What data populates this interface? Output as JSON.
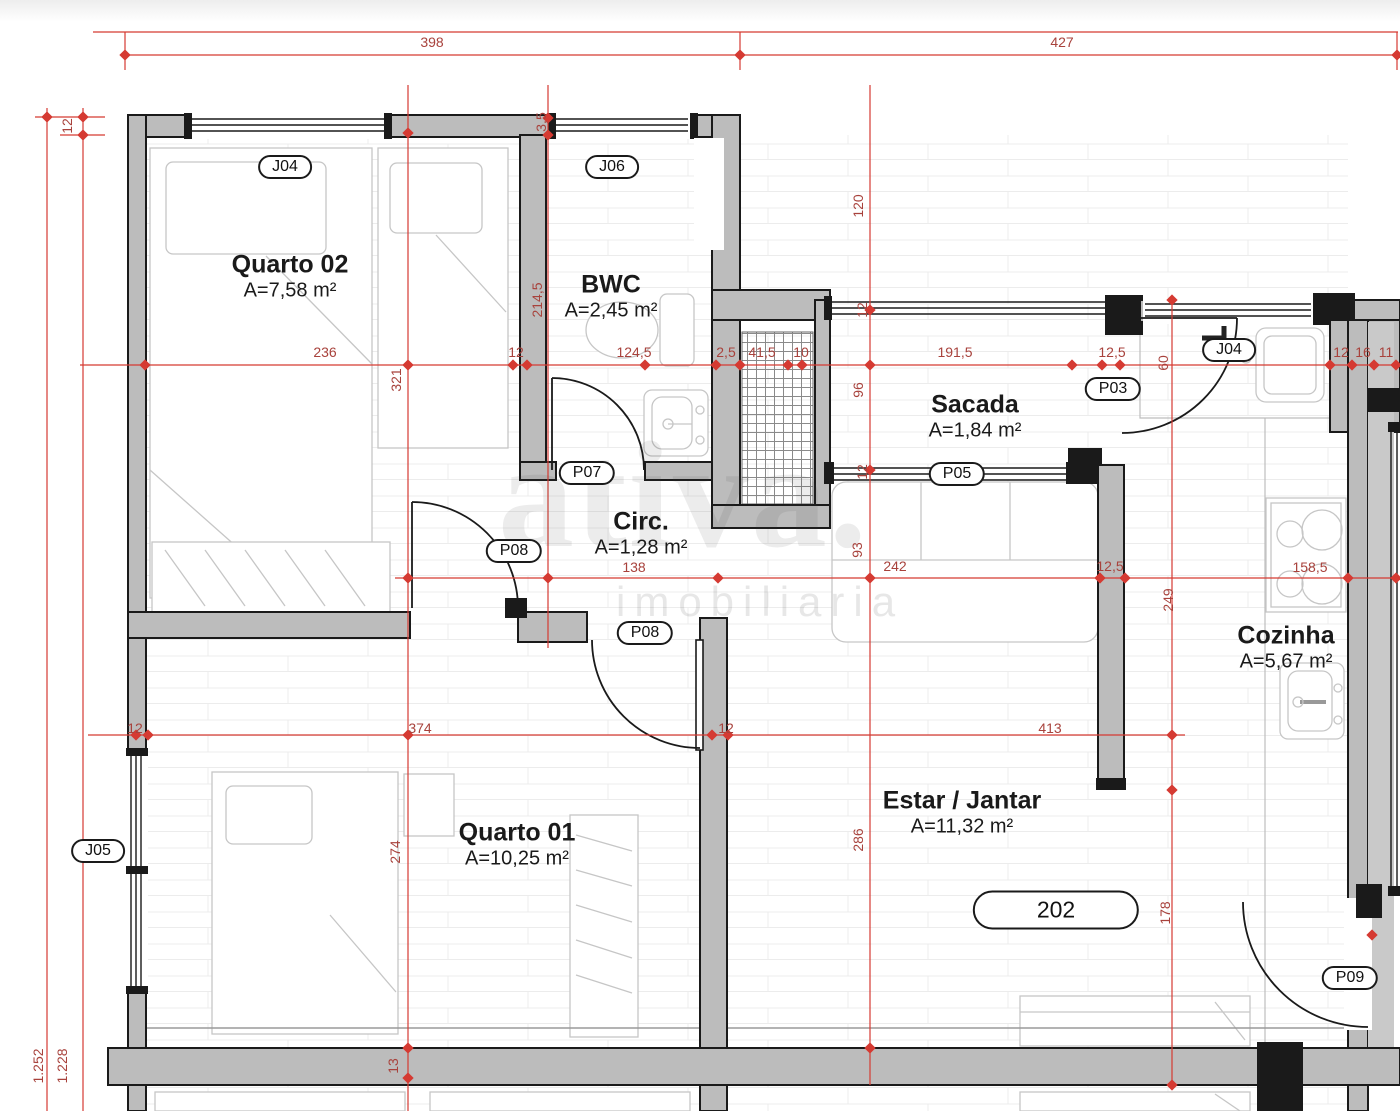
{
  "watermark": {
    "brand": "ativa.",
    "subtitle": "imobiliaria"
  },
  "unit_tag": {
    "label": "202",
    "x": 1056,
    "y": 910
  },
  "rooms": [
    {
      "id": "quarto-02",
      "name": "Quarto 02",
      "area": "A=7,58 m²",
      "x": 290,
      "y": 277
    },
    {
      "id": "bwc",
      "name": "BWC",
      "area": "A=2,45 m²",
      "x": 611,
      "y": 297
    },
    {
      "id": "sacada",
      "name": "Sacada",
      "area": "A=1,84 m²",
      "x": 975,
      "y": 417
    },
    {
      "id": "circ",
      "name": "Circ.",
      "area": "A=1,28 m²",
      "x": 641,
      "y": 534
    },
    {
      "id": "cozinha",
      "name": "Cozinha",
      "area": "A=5,67 m²",
      "x": 1286,
      "y": 648
    },
    {
      "id": "quarto-01",
      "name": "Quarto 01",
      "area": "A=10,25 m²",
      "x": 517,
      "y": 845
    },
    {
      "id": "estar-jantar",
      "name": "Estar / Jantar",
      "area": "A=11,32 m²",
      "x": 962,
      "y": 813
    }
  ],
  "door_window_tags": [
    {
      "label": "J04",
      "x": 285,
      "y": 167
    },
    {
      "label": "J06",
      "x": 612,
      "y": 167
    },
    {
      "label": "P07",
      "x": 587,
      "y": 473
    },
    {
      "label": "P08",
      "x": 514,
      "y": 551
    },
    {
      "label": "P08",
      "x": 645,
      "y": 633
    },
    {
      "label": "P05",
      "x": 957,
      "y": 474
    },
    {
      "label": "P03",
      "x": 1113,
      "y": 389
    },
    {
      "label": "J04",
      "x": 1229,
      "y": 350
    },
    {
      "label": "J05",
      "x": 98,
      "y": 851
    },
    {
      "label": "P09",
      "x": 1350,
      "y": 978
    }
  ],
  "dimensions_horizontal": [
    {
      "t": "398",
      "x": 432,
      "y": 42
    },
    {
      "t": "427",
      "x": 1062,
      "y": 42
    },
    {
      "t": "236",
      "x": 325,
      "y": 352
    },
    {
      "t": "12",
      "x": 516,
      "y": 352
    },
    {
      "t": "124,5",
      "x": 634,
      "y": 352
    },
    {
      "t": "2,5",
      "x": 726,
      "y": 352
    },
    {
      "t": "41,5",
      "x": 762,
      "y": 352
    },
    {
      "t": "10",
      "x": 801,
      "y": 352
    },
    {
      "t": "191,5",
      "x": 955,
      "y": 352
    },
    {
      "t": "12,5",
      "x": 1112,
      "y": 352
    },
    {
      "t": "12",
      "x": 1341,
      "y": 352
    },
    {
      "t": "16",
      "x": 1363,
      "y": 352
    },
    {
      "t": "11",
      "x": 1386,
      "y": 352
    },
    {
      "t": "138",
      "x": 634,
      "y": 567
    },
    {
      "t": "242",
      "x": 895,
      "y": 566
    },
    {
      "t": "12,5",
      "x": 1110,
      "y": 566
    },
    {
      "t": "158,5",
      "x": 1310,
      "y": 567
    },
    {
      "t": "374",
      "x": 420,
      "y": 728
    },
    {
      "t": "12",
      "x": 726,
      "y": 728
    },
    {
      "t": "413",
      "x": 1050,
      "y": 728
    },
    {
      "t": "12",
      "x": 135,
      "y": 728
    }
  ],
  "dimensions_vertical": [
    {
      "t": "12",
      "x": 67,
      "y": 126
    },
    {
      "t": "3,5",
      "x": 541,
      "y": 122
    },
    {
      "t": "214,5",
      "x": 537,
      "y": 300
    },
    {
      "t": "120",
      "x": 858,
      "y": 206
    },
    {
      "t": "12",
      "x": 862,
      "y": 310
    },
    {
      "t": "96",
      "x": 858,
      "y": 390
    },
    {
      "t": "12",
      "x": 862,
      "y": 472
    },
    {
      "t": "321",
      "x": 396,
      "y": 380
    },
    {
      "t": "93",
      "x": 857,
      "y": 550
    },
    {
      "t": "60",
      "x": 1163,
      "y": 363
    },
    {
      "t": "249",
      "x": 1168,
      "y": 600
    },
    {
      "t": "274",
      "x": 395,
      "y": 852
    },
    {
      "t": "286",
      "x": 858,
      "y": 840
    },
    {
      "t": "178",
      "x": 1165,
      "y": 913
    },
    {
      "t": "13",
      "x": 393,
      "y": 1066
    },
    {
      "t": "1.252",
      "x": 38,
      "y": 1066
    },
    {
      "t": "1.228",
      "x": 62,
      "y": 1066
    }
  ],
  "colors": {
    "dimension_line": "#d53a32",
    "dimension_text": "#a8423c",
    "wall_fill": "#bcbcbc",
    "wall_line": "#1a1a1a"
  }
}
